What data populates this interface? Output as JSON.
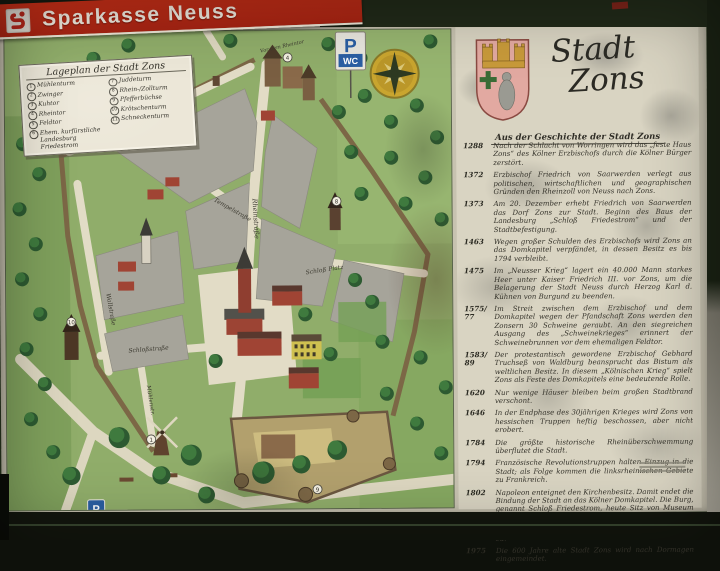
{
  "banner": {
    "brand": "Sparkasse Neuss"
  },
  "map": {
    "legend": {
      "title": "Lageplan der Stadt Zons",
      "col1": [
        {
          "n": "1",
          "label": "Mühlenturm"
        },
        {
          "n": "2",
          "label": "Zwinger"
        },
        {
          "n": "3",
          "label": "Kuhtor"
        },
        {
          "n": "4",
          "label": "Rheintor"
        },
        {
          "n": "5",
          "label": "Feldtor"
        },
        {
          "n": "6",
          "label": "Ehem. kurfürstliche Landesburg Friedestrom"
        }
      ],
      "col2": [
        {
          "n": "7",
          "label": "Juddeturm"
        },
        {
          "n": "8",
          "label": "Rhein-/Zollturm"
        },
        {
          "n": "9",
          "label": "Pfefferbüchse"
        },
        {
          "n": "10",
          "label": "Krötschenturm"
        },
        {
          "n": "11",
          "label": "Schneckenturm"
        }
      ]
    },
    "labels": {
      "mauerstrasse": "Mauerstraße",
      "rheinstrasse": "Rheinstraße",
      "wallstrasse": "Wallstraße",
      "tempelstrasse": "Tempelstraße",
      "schlossstrasse": "Schloßstraße",
      "muehlenstrasse": "Mühlenstr.",
      "schloss_platz": "Schloß Platz",
      "vor_dem_rheintor": "Vor dem Rheintor"
    },
    "signs": {
      "parking": "P",
      "wc": "WC",
      "parking_lower": "P"
    },
    "markers": {
      "windmill": "1",
      "rheintor": "4",
      "zollturm": "8",
      "gate": "9",
      "kroetschenturm": "10"
    }
  },
  "history": {
    "title_line1": "Stadt",
    "title_line2": "Zons",
    "subtitle": "Aus der Geschichte der Stadt Zons",
    "entries": [
      {
        "year": "1288",
        "text": "Nach der Schlacht von Worringen wird das „feste Haus Zons“ des Kölner Erzbischofs durch die Kölner Bürger zerstört."
      },
      {
        "year": "1372",
        "text": "Erzbischof Friedrich von Saarwerden verlegt aus politischen, wirtschaftlichen und geographischen Gründen den Rheinzoll von Neuss nach Zons."
      },
      {
        "year": "1373",
        "text": "Am 20. Dezember erhebt Friedrich von Saarwerden das Dorf Zons zur Stadt. Beginn des Baus der Landesburg „Schloß Friedestrom“ und der Stadtbefestigung."
      },
      {
        "year": "1463",
        "text": "Wegen großer Schulden des Erzbischofs wird Zons an das Domkapitel verpfändet, in dessen Besitz es bis 1794 verbleibt."
      },
      {
        "year": "1475",
        "text": "Im „Neusser Krieg“ lagert ein 40.000 Mann starkes Heer unter Kaiser Friedrich III. vor Zons, um die Belagerung der Stadt Neuss durch Herzog Karl d. Kühnen von Burgund zu beenden."
      },
      {
        "year": "1575/77",
        "text": "Im Streit zwischen dem Erzbischof und dem Domkapitel wegen der Pfandschaft Zons werden den Zonsern 30 Schweine geraubt. An den siegreichen Ausgang des „Schweinekrieges“ erinnert der Schweinebrunnen vor dem ehemaligen Feldtor."
      },
      {
        "year": "1583/89",
        "text": "Der protestantisch gewordene Erzbischof Gebhard Truchseß von Waldburg beansprucht das Bistum als weltlichen Besitz. In diesem „Kölnischen Krieg“ spielt Zons als Feste des Domkapitels eine bedeutende Rolle."
      },
      {
        "year": "1620",
        "text": "Nur wenige Häuser bleiben beim großen Stadtbrand verschont."
      },
      {
        "year": "1646",
        "text": "In der Endphase des 30jährigen Krieges wird Zons von hessischen Truppen heftig beschossen, aber nicht erobert."
      },
      {
        "year": "1784",
        "text": "Die größte historische Rheinüberschwemmung überflutet die Stadt."
      },
      {
        "year": "1794",
        "text": "Französische Revolutionstruppen halten Einzug in die Stadt; als Folge kommen die linksrheinischen Gebiete zu Frankreich."
      },
      {
        "year": "1802",
        "text": "Napoleon enteignet den Kirchenbesitz. Damit endet die Bindung der Stadt an das Kölner Domkapitel. Die Burg, genannt Schloß Friedestrom, heute Sitz von Museum und Archiven, wird verkauft."
      },
      {
        "year": "1815",
        "text": "Der Wiener Kongreß schlägt die Rheinlande Preußen zu."
      },
      {
        "year": "1975",
        "text": "Die 600 Jahre alte Stadt Zons wird nach Dormagen eingemeindet."
      }
    ]
  },
  "colors": {
    "banner_red": "#c0281c",
    "map_green": "#90ad6a",
    "street": "#e2dcc6",
    "block_gray": "#a6a49a",
    "wall_brown": "#7c6746",
    "tree_green": "#2d5a31",
    "brick_red": "#a04434",
    "panel_cream": "#d9d4c2",
    "sign_blue": "#2b5fa3",
    "compass_gold": "#c9a52f",
    "shield_pink": "#e2a9a1",
    "frame_green": "#26331d"
  }
}
